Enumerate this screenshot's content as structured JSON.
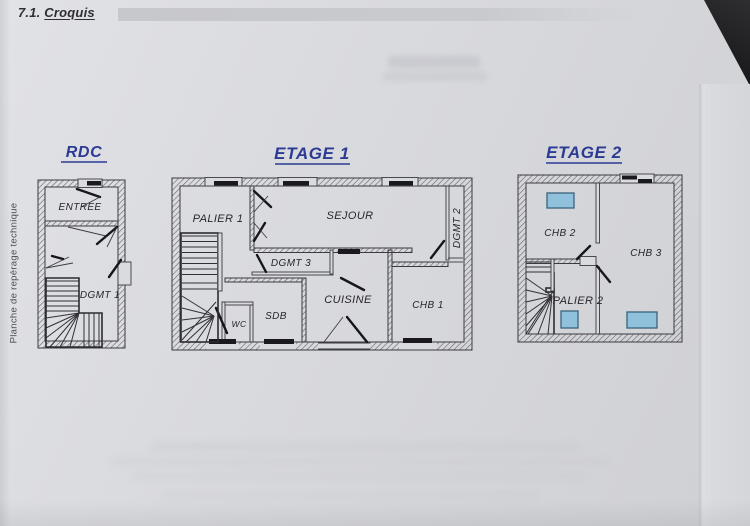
{
  "page": {
    "heading": {
      "number": "7.1.",
      "title": "Croquis"
    },
    "side_label": "Planche de repérage technique"
  },
  "plans": {
    "rdc": {
      "title": "RDC",
      "rooms": {
        "entree": "ENTREE",
        "dgmt1": "DGMT 1"
      }
    },
    "etage1": {
      "title": "ETAGE 1",
      "rooms": {
        "palier1": "PALIER 1",
        "sejour": "SEJOUR",
        "dgmt2": "DGMT 2",
        "dgmt3": "DGMT 3",
        "cuisine": "CUISINE",
        "chb1": "CHB 1",
        "sdb": "SDB",
        "wc": "WC"
      }
    },
    "etage2": {
      "title": "ETAGE 2",
      "rooms": {
        "chb2": "CHB 2",
        "chb3": "CHB 3",
        "palier2": "PALIER 2"
      }
    }
  },
  "colors": {
    "title_blue": "#2b3a94",
    "velux_blue": "#8fc0dc",
    "wall_ink": "#3a3a40",
    "paper": "#d8d9dd",
    "band_gray": "#c9cacd"
  }
}
